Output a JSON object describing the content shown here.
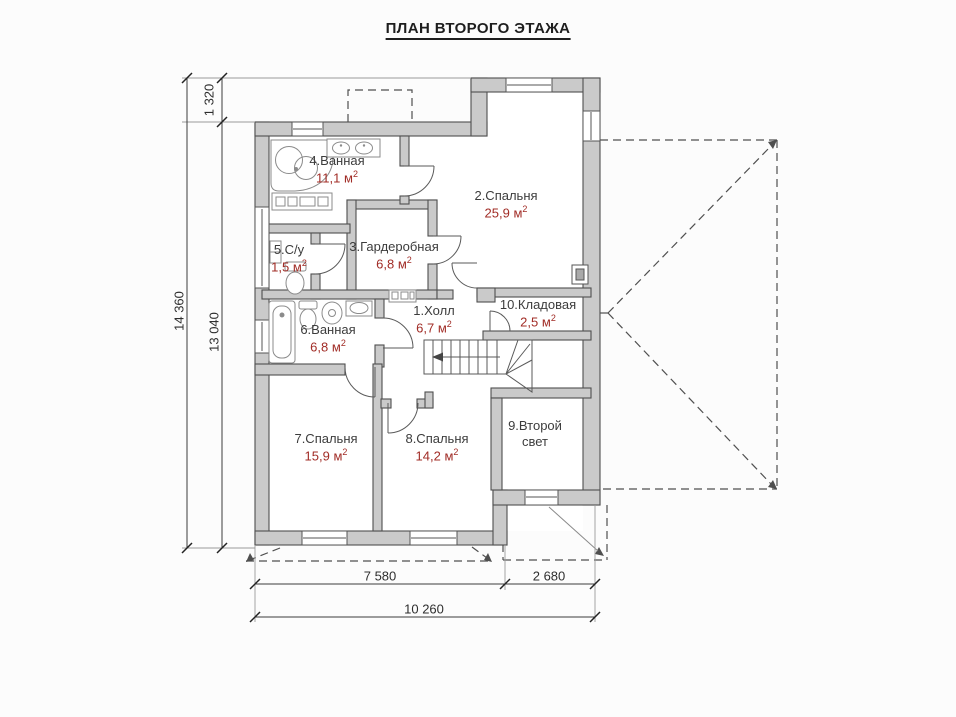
{
  "title": "ПЛАН ВТОРОГО ЭТАЖА",
  "rooms": [
    {
      "label": "1.Холл",
      "area_value": "6,7",
      "area_unit": " м",
      "area_sup": "2"
    },
    {
      "label": "2.Спальня",
      "area_value": "25,9",
      "area_unit": " м",
      "area_sup": "2"
    },
    {
      "label": "3.Гардеробная",
      "area_value": "6,8",
      "area_unit": " м",
      "area_sup": "2"
    },
    {
      "label": "4.Ванная",
      "area_value": "11,1",
      "area_unit": " м",
      "area_sup": "2"
    },
    {
      "label": "5.С/у",
      "area_value": "1,5",
      "area_unit": " м",
      "area_sup": "2"
    },
    {
      "label": "6.Ванная",
      "area_value": "6,8",
      "area_unit": " м",
      "area_sup": "2"
    },
    {
      "label": "7.Спальня",
      "area_value": "15,9",
      "area_unit": " м",
      "area_sup": "2"
    },
    {
      "label": "8.Спальня",
      "area_value": "14,2",
      "area_unit": " м",
      "area_sup": "2"
    },
    {
      "label": "9.Второй свет",
      "area_value": "",
      "area_unit": "",
      "area_sup": ""
    },
    {
      "label": "10.Кладовая",
      "area_value": "2,5",
      "area_unit": " м",
      "area_sup": "2"
    }
  ],
  "dimensions": {
    "left_total": "14 360",
    "left_main": "13 040",
    "left_top": "1 320",
    "bottom_main": "7 580",
    "bottom_right": "2 680",
    "bottom_total": "10 260"
  },
  "colors": {
    "wall_fill": "#cacaca",
    "wall_stroke": "#4f4f4f",
    "area_text": "#a12c26",
    "room_text": "#3c3c3c",
    "dim_text": "#2e2e2e",
    "roof_dash": "#4f4f4f",
    "background": "#fcfcfc"
  }
}
